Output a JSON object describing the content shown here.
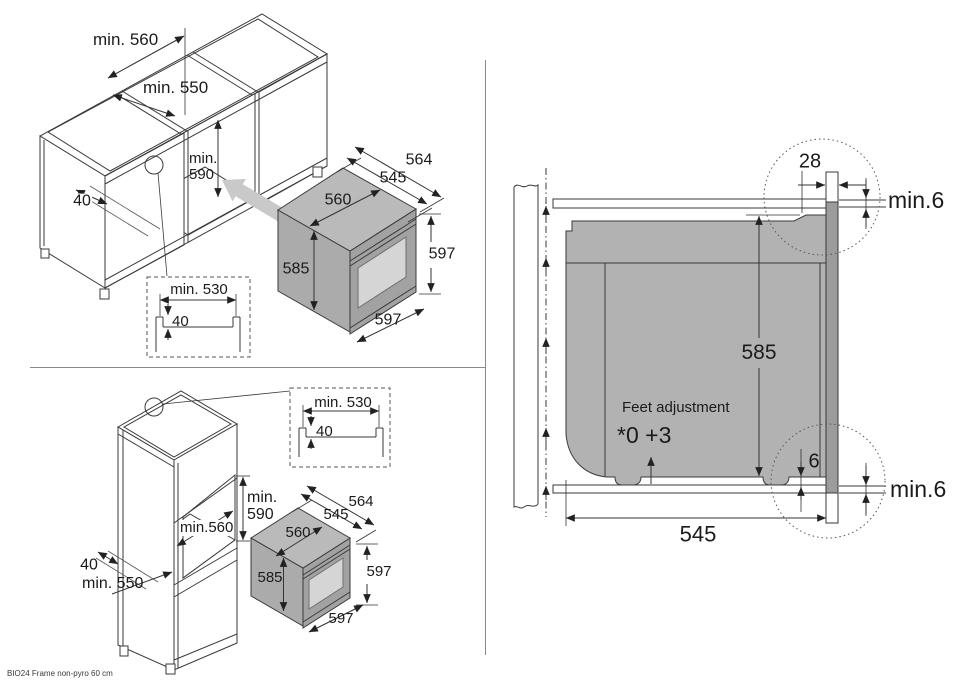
{
  "footer": {
    "model_label": "BIO24 Frame non-pyro 60 cm"
  },
  "base_cabinet": {
    "niche_width": "min. 560",
    "niche_depth": "min. 550",
    "niche_height": "min. 590",
    "frame_width": "40",
    "cutout": {
      "width": "min. 530",
      "step": "40"
    }
  },
  "tall_cabinet": {
    "niche_height": "min. 590",
    "niche_width": "min.560",
    "frame_width": "40",
    "niche_depth": "min. 550",
    "cutout": {
      "width": "min. 530",
      "step": "40"
    }
  },
  "oven": {
    "depth_total": "564",
    "depth_body": "545",
    "top_width": "560",
    "body_height": "585",
    "front_height": "597",
    "front_width": "597"
  },
  "side_view": {
    "frame_lip": "28",
    "top_clearance": "min.6",
    "body_height": "585",
    "feet_adjustment_label": "Feet adjustment",
    "feet_adjustment_range": "*0 +3",
    "bottom_gap": "6",
    "bottom_clearance": "min.6",
    "body_depth": "545"
  }
}
